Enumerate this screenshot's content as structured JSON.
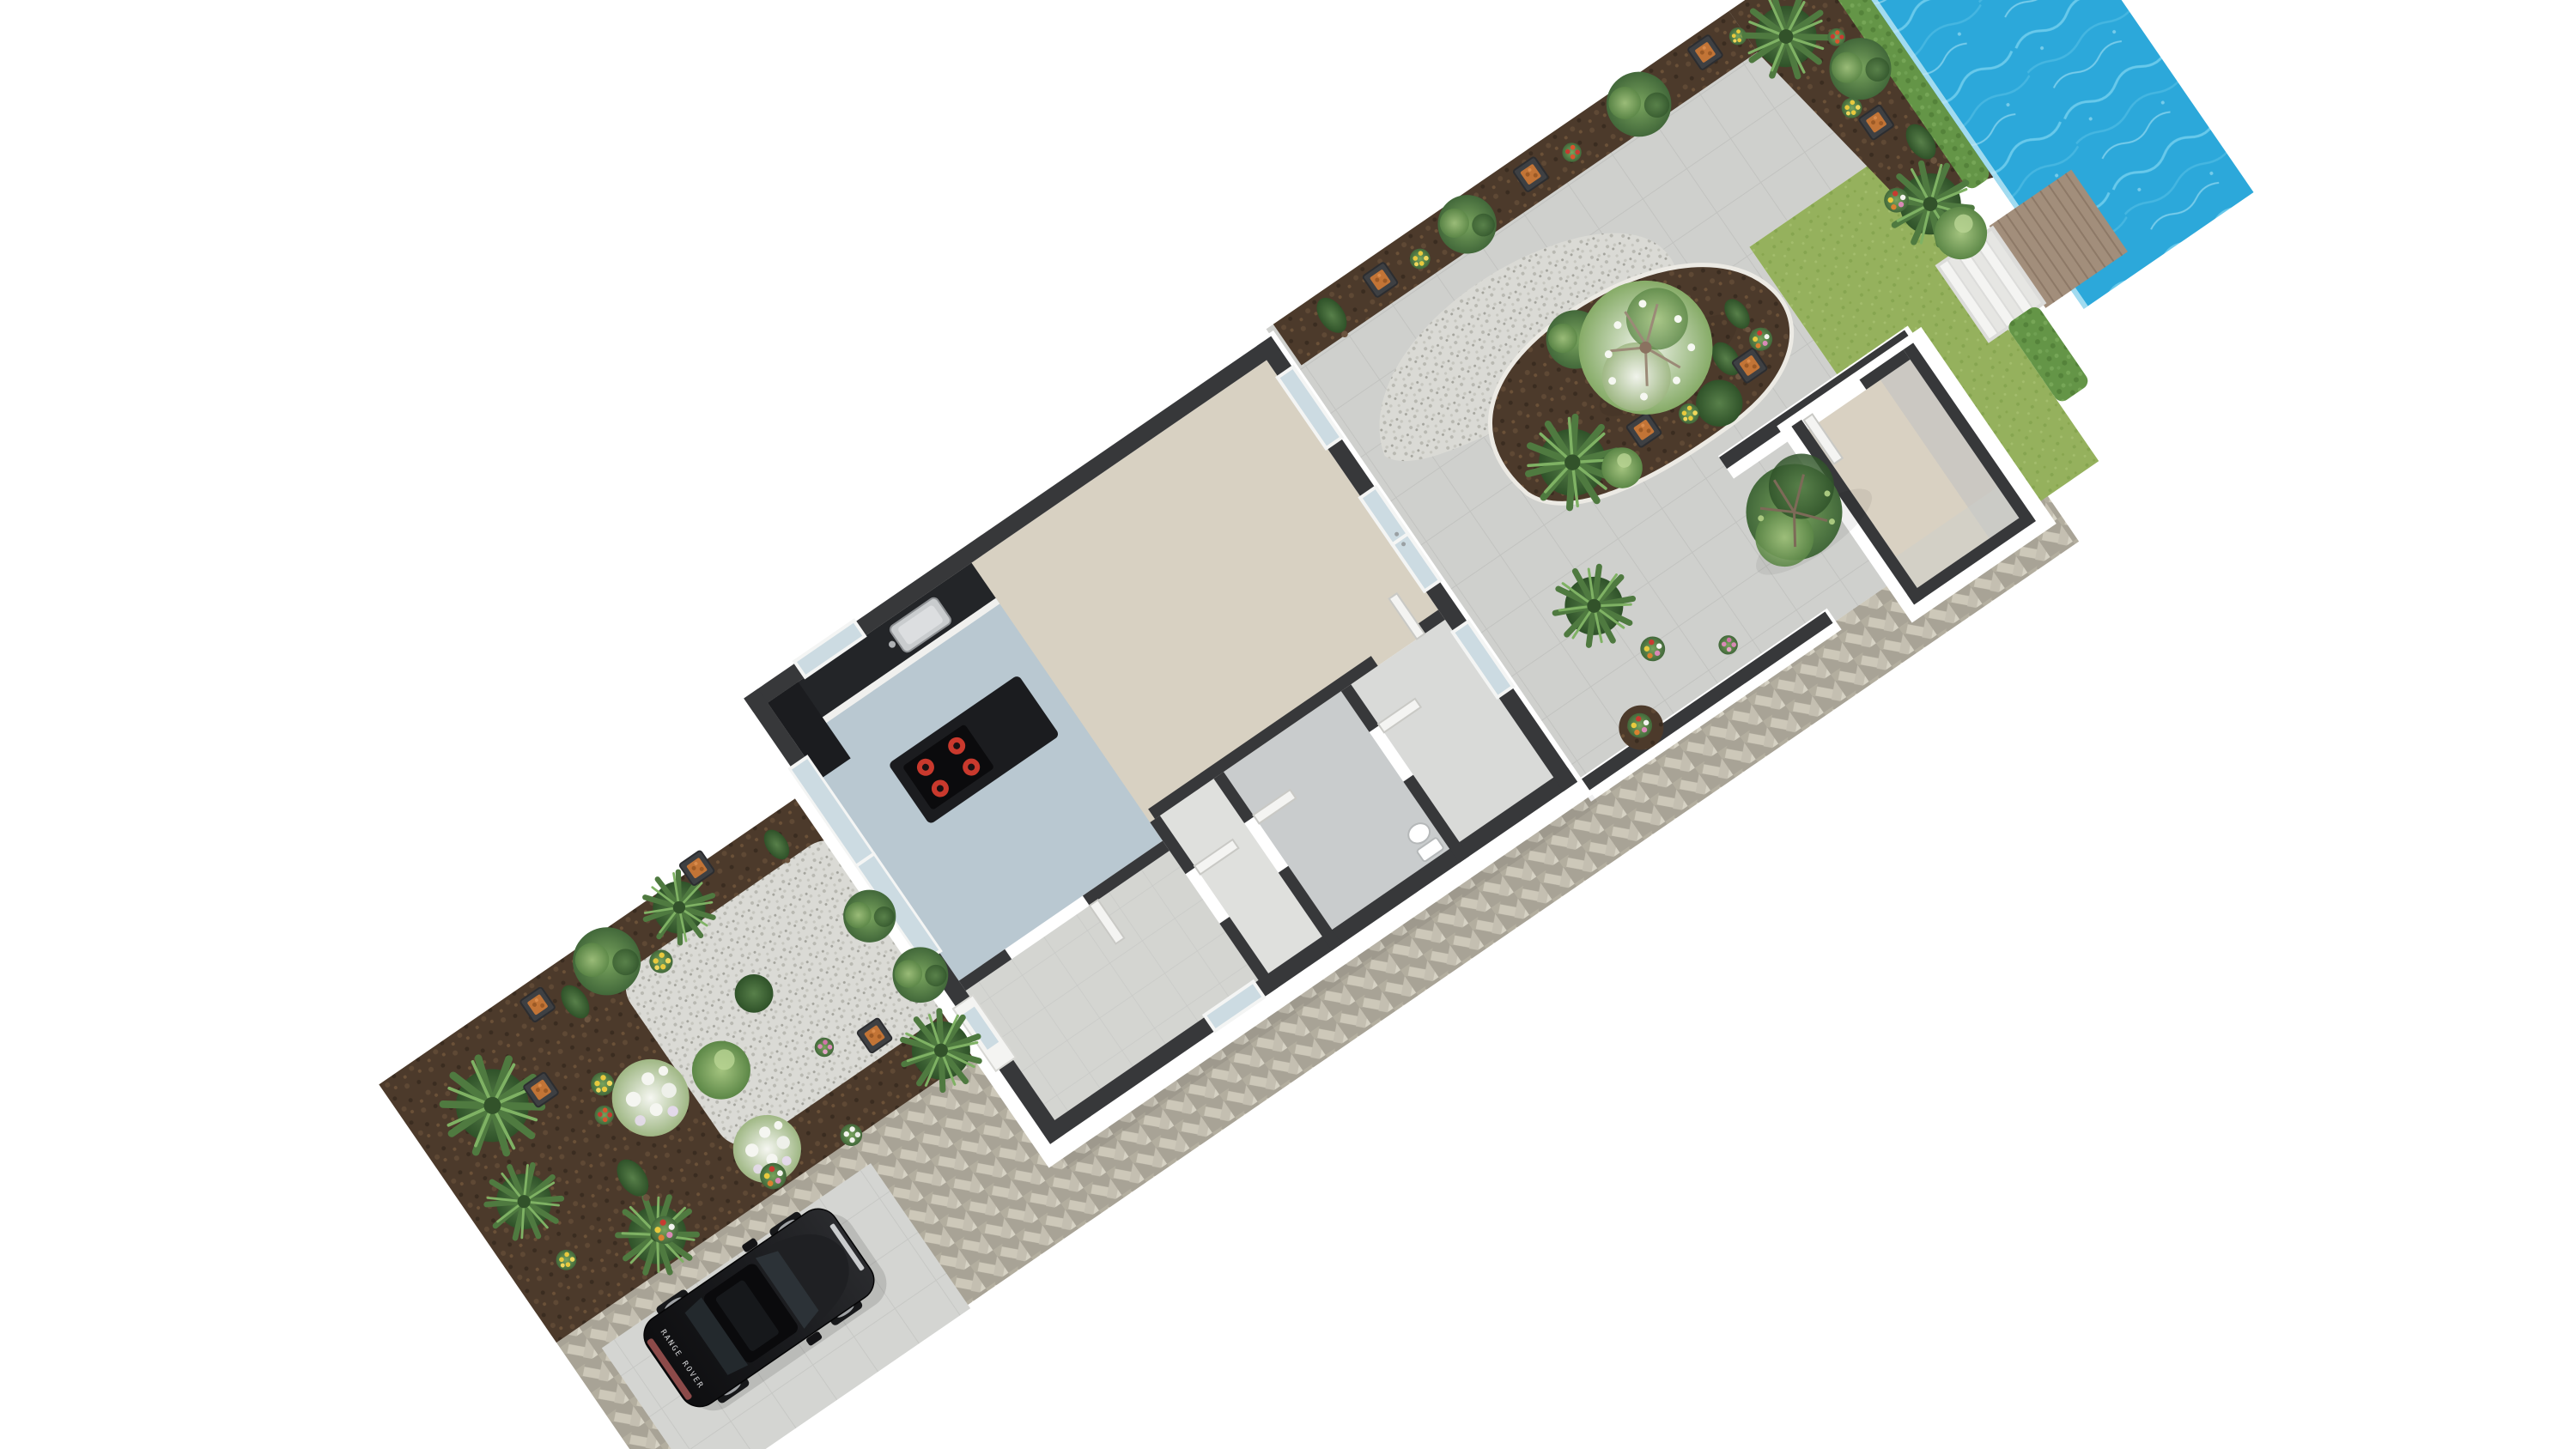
{
  "scene": {
    "title": "3D floor plan render — canal-side plot",
    "view": "rotated top-down axonometric",
    "background": "#ffffff"
  },
  "colors": {
    "wall_top": "#37383a",
    "wall_face": "#ffffff",
    "floor_living": "#d8d1c2",
    "floor_kitchen": "#b9c8d1",
    "floor_hall": "#d4d5d1",
    "floor_corridor": "#dfe0dd",
    "floor_bath": "#c9cccd",
    "floor_storage": "#d9dad8",
    "shed_floor": "#d9d1c2",
    "patio": "#cfd0cd",
    "patio_line": "#c2c3c0",
    "slab": "#d4d5d2",
    "slab_line": "#c7c8c5",
    "gravel": "#dadad5",
    "soil": "#4c3a2b",
    "grass": "#95b15d",
    "hedge": "#649547",
    "herring_joint": "#a8a396",
    "herring_brick1": "#cdc8b9",
    "herring_brick2": "#b3ae9f",
    "herring_brick3": "#d6d2c4",
    "water": "#2ca8da",
    "water_ripple": "#7cd4f0",
    "deck": "#a28e7b",
    "deck_line": "#8d7967",
    "step": "#f4f4f2",
    "counter": "#232528",
    "island": "#1b1c1f",
    "cooktop": "#0b0b0d",
    "burner": "#c9392d",
    "sink": "#c9ccce",
    "glass": "#ccdbe2",
    "frame": "#f4f5f4",
    "door": "#f4f4f2",
    "curb": "#eceae4",
    "planter": "#3e4043",
    "planter_fill": "#c27436",
    "car_body_dark": "#0e0e10",
    "car_body_light": "#2a2b2e",
    "car_glass": "#2c3237",
    "car_roof": "#0a0a0c",
    "car_taillight": "#8c4a49",
    "car_grill": "#caccce"
  },
  "objects": {
    "car_badge": "RANGE ROVER",
    "inventory": [
      "front garden",
      "gravel terrace",
      "driveway",
      "parked black SUV",
      "herringbone brick path",
      "house shell",
      "kitchen with sink and island cooktop",
      "living room",
      "entrance hall",
      "corridor",
      "bathroom with toilet",
      "storage room",
      "back patio",
      "planting beds",
      "gravel path",
      "lawn",
      "garden walls",
      "shed",
      "hedges",
      "white jetty steps",
      "wooden jetty",
      "canal water"
    ]
  }
}
